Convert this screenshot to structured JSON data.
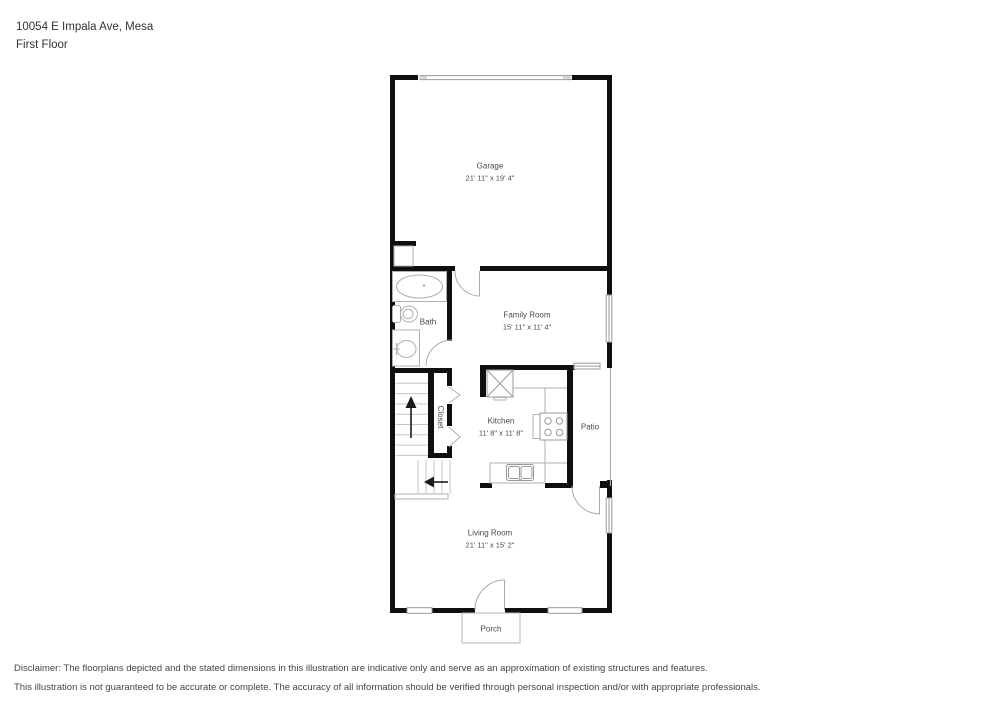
{
  "header": {
    "address": "10054 E Impala Ave, Mesa",
    "floor": "First Floor"
  },
  "rooms": [
    {
      "id": "garage",
      "name": "Garage",
      "dims": "21' 11\" x 19' 4\""
    },
    {
      "id": "family-room",
      "name": "Family Room",
      "dims": "15' 11\" x 11' 4\""
    },
    {
      "id": "bath",
      "name": "Bath"
    },
    {
      "id": "closet",
      "name": "Closet"
    },
    {
      "id": "kitchen",
      "name": "Kitchen",
      "dims": "11' 8\" x 11' 8\""
    },
    {
      "id": "patio",
      "name": "Patio"
    },
    {
      "id": "living-room",
      "name": "Living Room",
      "dims": "21' 11\" x 15' 2\""
    },
    {
      "id": "porch",
      "name": "Porch"
    }
  ],
  "disclaimer": {
    "line1": "Disclaimer: The floorplans depicted and the stated dimensions in this illustration are indicative only and serve as an approximation of existing structures and features.",
    "line2": "This illustration is not guaranteed to be accurate or complete. The accuracy of all information should be verified through personal inspection and/or with appropriate professionals."
  },
  "colors": {
    "wall": "#0f0f0f",
    "fixture": "#b0b0b0",
    "tread": "#c6c6c6",
    "door": "#aaaaaa",
    "label": "#4a4a4a"
  }
}
